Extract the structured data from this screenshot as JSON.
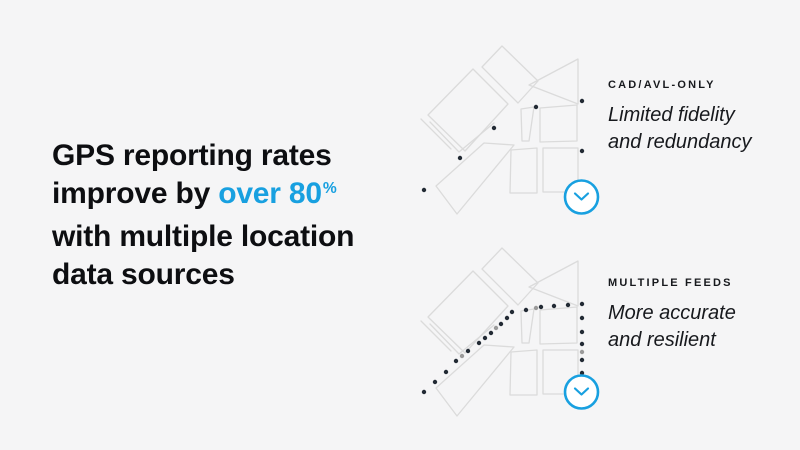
{
  "slide": {
    "background_color": "#f5f5f6",
    "accent_color": "#18a0e0",
    "text_color": "#0d0e11"
  },
  "headline": {
    "line1": "GPS reporting rates",
    "line2_prefix": "improve by ",
    "line2_highlight": "over 80",
    "line2_superscript": "%",
    "line3": "with multiple location",
    "line4": "data sources"
  },
  "comparison": {
    "top": {
      "label": "CAD/AVL-ONLY",
      "desc_line1": "Limited fidelity",
      "desc_line2": "and redundancy"
    },
    "bottom": {
      "label": "MULTIPLE FEEDS",
      "desc_line1": "More accurate",
      "desc_line2": "and resilient"
    }
  },
  "maps": {
    "street_line_color": "#dbdbdb",
    "dot_color": "#222a34",
    "dot_gray_color": "#9b9b9b",
    "badge_color": "#18a0e0",
    "map1": {
      "name": "cad-avl-only-map",
      "dots": [
        [
          16,
          162
        ],
        [
          52,
          130
        ],
        [
          86,
          100
        ],
        [
          128,
          79
        ],
        [
          174,
          73
        ],
        [
          174,
          123
        ]
      ]
    },
    "map2": {
      "name": "multiple-feeds-map",
      "dots": [
        [
          16,
          162
        ],
        [
          27,
          152
        ],
        [
          38,
          142
        ],
        [
          48,
          131
        ],
        [
          54,
          126,
          "gray"
        ],
        [
          60,
          121
        ],
        [
          71,
          113
        ],
        [
          77,
          108
        ],
        [
          83,
          103
        ],
        [
          88,
          98,
          "gray"
        ],
        [
          93,
          94
        ],
        [
          99,
          88
        ],
        [
          104,
          82
        ],
        [
          118,
          80
        ],
        [
          128,
          78,
          "gray"
        ],
        [
          133,
          77
        ],
        [
          146,
          76
        ],
        [
          160,
          75
        ],
        [
          174,
          74
        ],
        [
          174,
          88
        ],
        [
          174,
          102
        ],
        [
          174,
          114
        ],
        [
          174,
          122,
          "gray"
        ],
        [
          174,
          130
        ],
        [
          174,
          143
        ]
      ]
    }
  }
}
